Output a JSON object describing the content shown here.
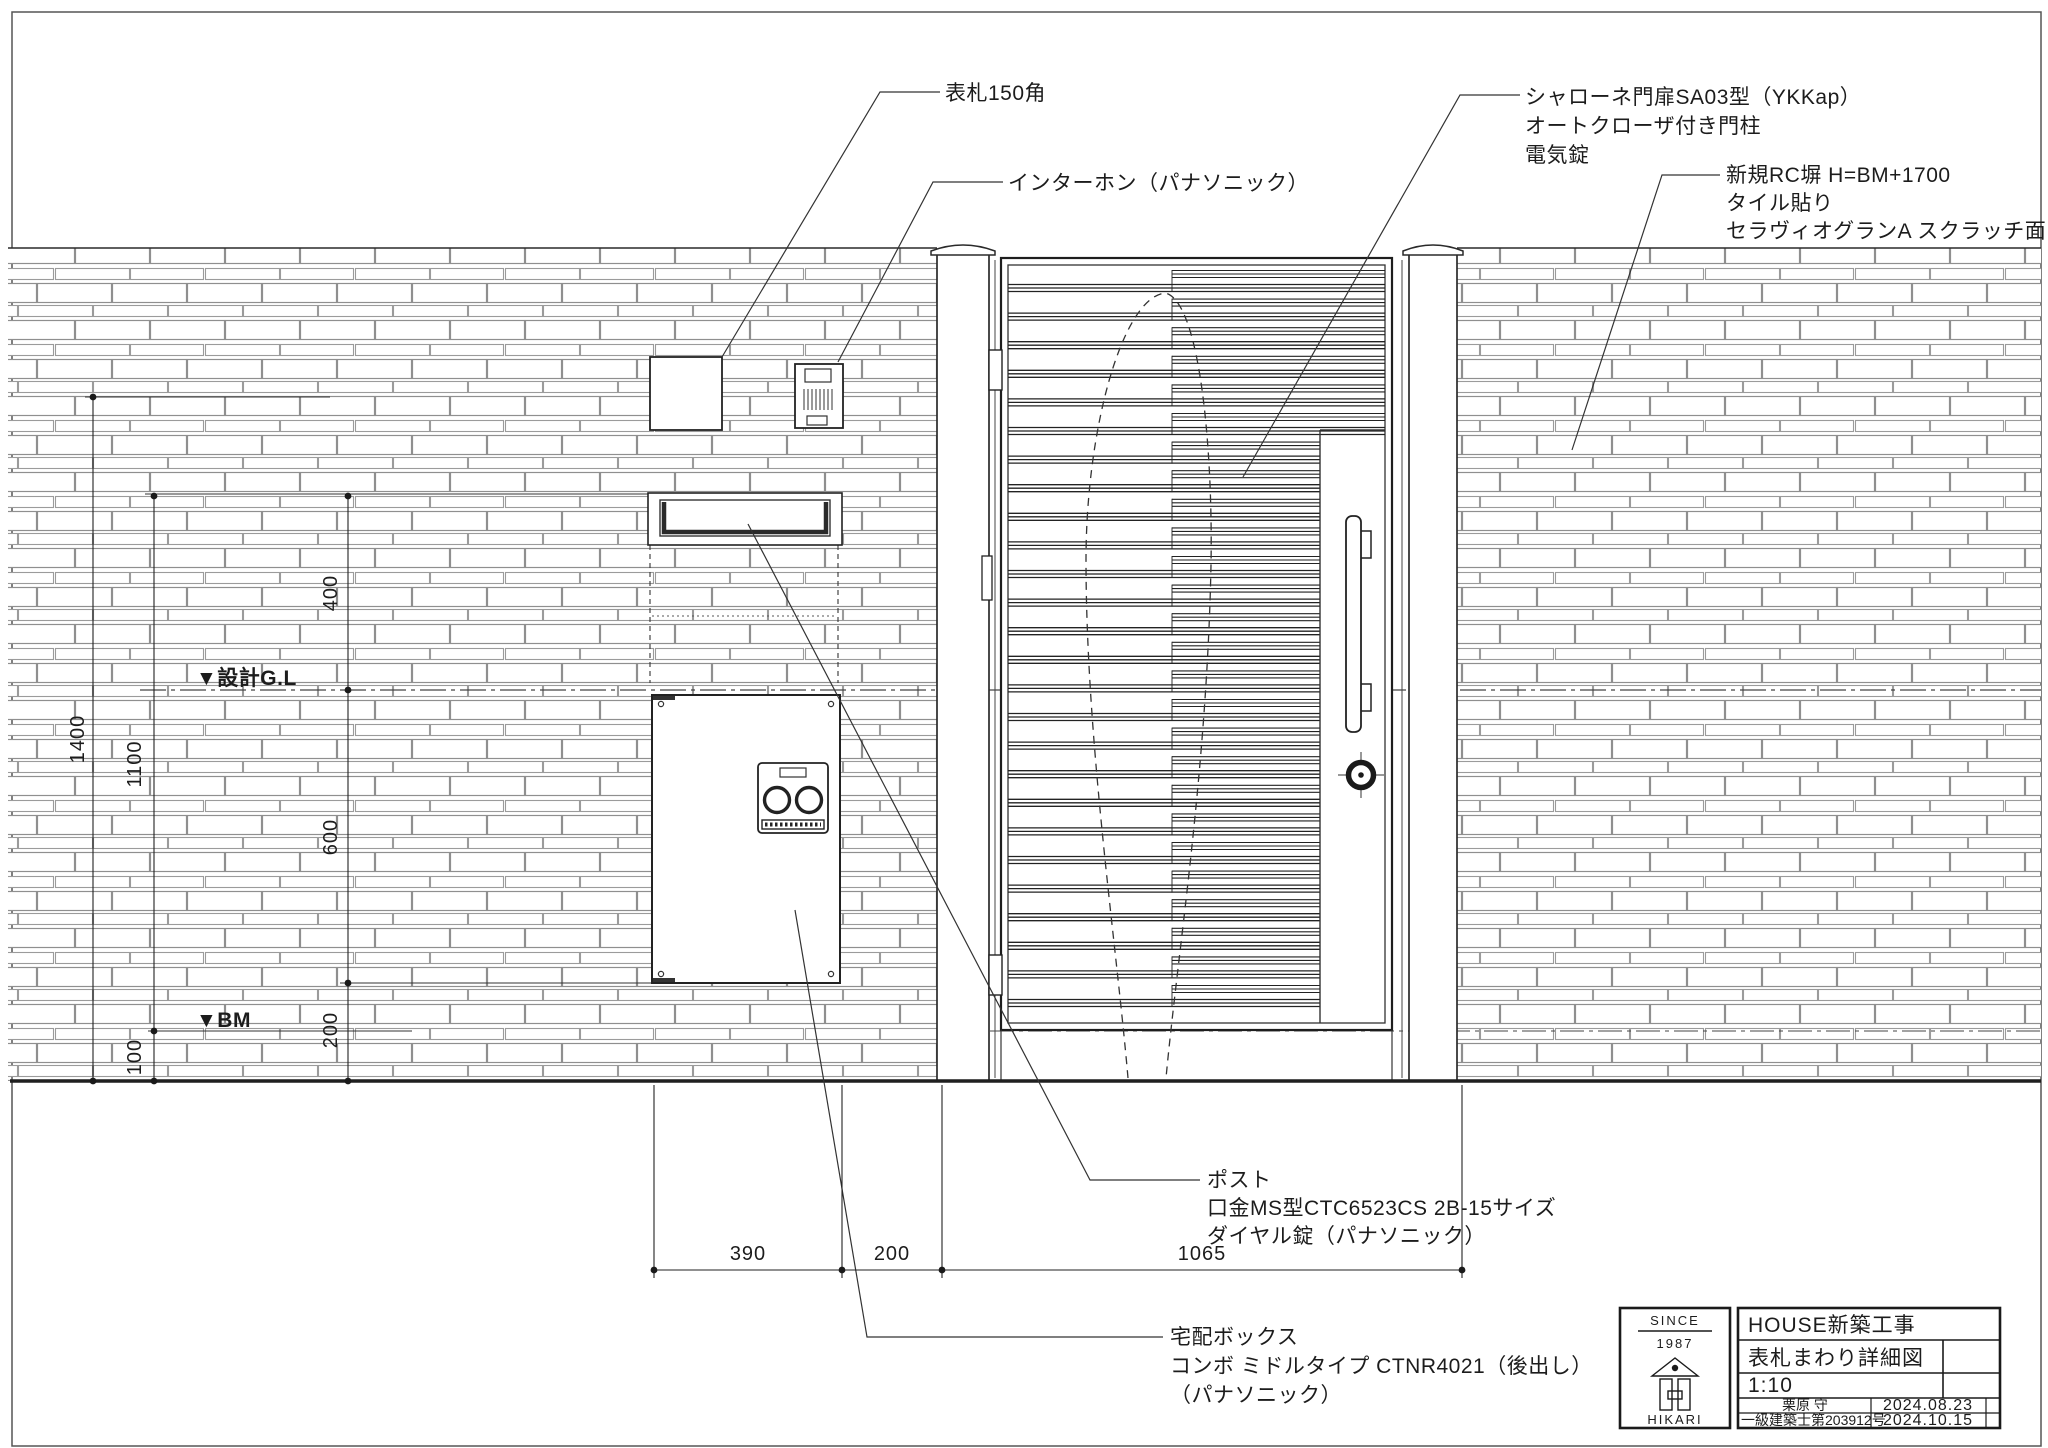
{
  "drawing": {
    "callouts": {
      "nameplate": {
        "text": "表札150角"
      },
      "intercom": {
        "text": "インターホン（パナソニック）"
      },
      "gate": {
        "line1": "シャローネ門扉SA03型（YKKap）",
        "line2": "オートクローザ付き門柱",
        "line3": "電気錠"
      },
      "wall": {
        "line1": "新規RC塀 H=BM+1700",
        "line2": "タイル貼り",
        "line3": "セラヴィオグランA スクラッチ面（LIXIL）"
      },
      "post": {
        "line1": "ポスト",
        "line2": "口金MS型CTC6523CS 2B-15サイズ",
        "line3": "ダイヤル錠（パナソニック）"
      },
      "delivery": {
        "line1": "宅配ボックス",
        "line2": "コンボ ミドルタイプ CTNR4021（後出し）",
        "line3": "（パナソニック）"
      }
    },
    "levels": {
      "gl": "▼設計G.L",
      "bm": "▼BM"
    },
    "dims": {
      "h390": "390",
      "h200": "200",
      "h1065": "1065",
      "v1400": "1400",
      "v1100": "1100",
      "v400": "400",
      "v600": "600",
      "v200": "200",
      "v100": "100"
    }
  },
  "titleblock": {
    "since": "SINCE",
    "year": "1987",
    "company": "HIKARI",
    "project": "HOUSE新築工事",
    "sheet_title": "表札まわり詳細図",
    "scale": "1:10",
    "architect_name": "栗原 守",
    "license": "一級建築士第203912号",
    "date1": "2024.08.23",
    "date2": "2024.10.15"
  }
}
